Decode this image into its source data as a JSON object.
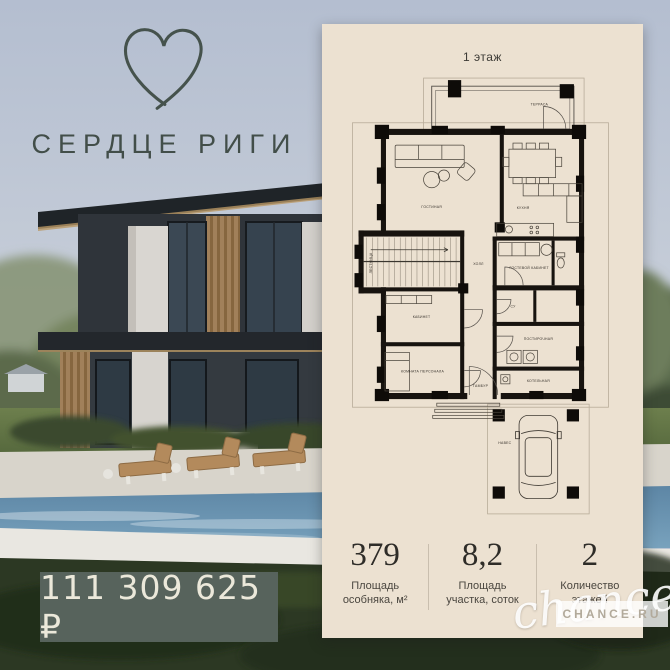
{
  "brand": {
    "title": "СЕРДЦЕ РИГИ",
    "logo": "heart-outline-icon"
  },
  "price": {
    "value": "111 309 625 ₽",
    "badge_color": "#57635c"
  },
  "photo": {
    "subject": "two-storey modern house with pool and lounge chairs"
  },
  "plan": {
    "floor_title": "1 этаж",
    "rooms": [
      {
        "label": "ТЕРРАСА"
      },
      {
        "label": "ГОСТИНАЯ"
      },
      {
        "label": "КУХНЯ"
      },
      {
        "label": "ГОСТЕВОЙ КАБИНЕТ"
      },
      {
        "label": "ХОЛЛ"
      },
      {
        "label": "ЛЕСТНИЦА"
      },
      {
        "label": "КАБИНЕТ"
      },
      {
        "label": "КОМНАТА ПЕРСОНАЛА"
      },
      {
        "label": "СУ"
      },
      {
        "label": "ПОСТИРОЧНАЯ"
      },
      {
        "label": "КОТЕЛЬНАЯ"
      },
      {
        "label": "ТАМБУР"
      },
      {
        "label": "НАВЕС"
      }
    ],
    "stats": [
      {
        "value": "379",
        "line1": "Площадь",
        "line2": "особняка, м²"
      },
      {
        "value": "8,2",
        "line1": "Площадь",
        "line2": "участка, соток"
      },
      {
        "value": "2",
        "line1": "Количество",
        "line2": "этажей"
      }
    ]
  },
  "watermark": {
    "script": "chance",
    "box": "CHANCE.RU"
  },
  "colors": {
    "panel": "#ece1d1",
    "badge": "#57635c",
    "logo": "#45524c",
    "walls": "#17130f"
  }
}
